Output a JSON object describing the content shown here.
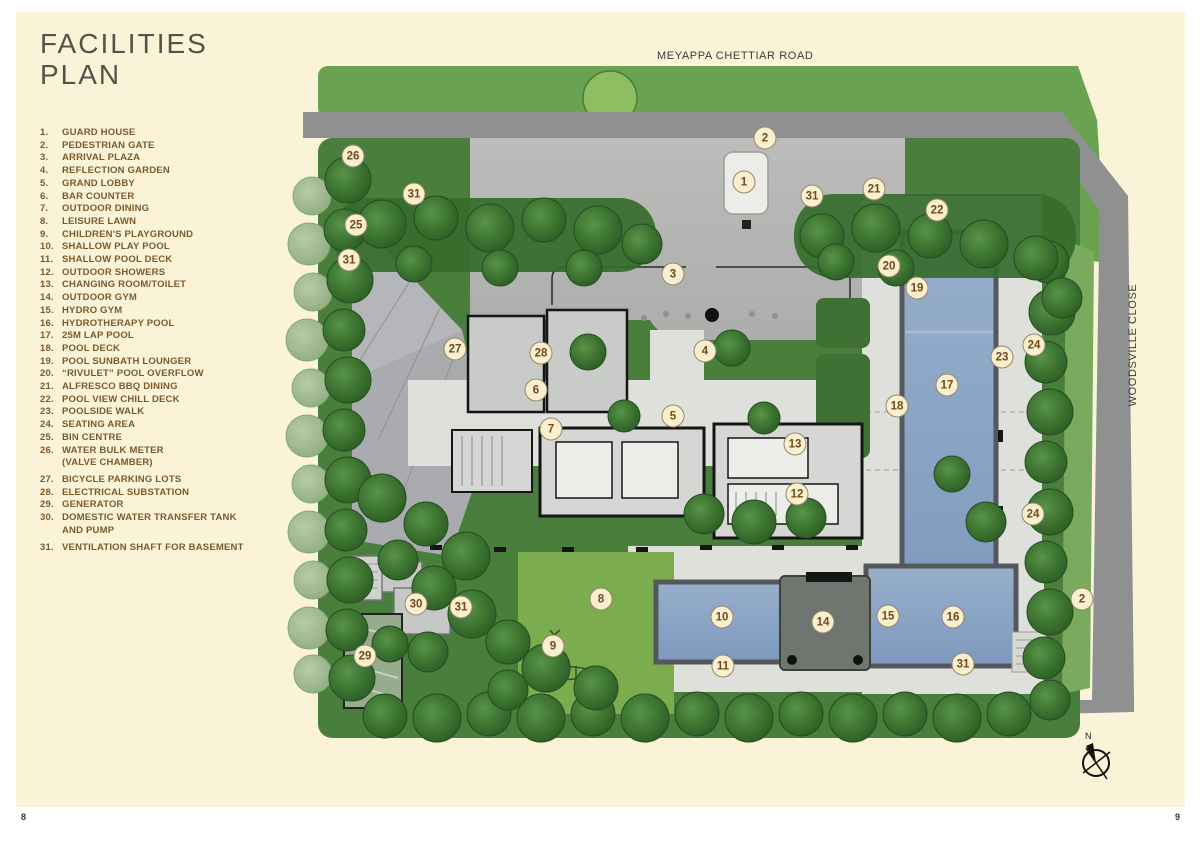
{
  "page": {
    "title_line1": "FACILITIES",
    "title_line2": "PLAN",
    "page_number_left": "8",
    "page_number_right": "9"
  },
  "roads": {
    "top_label": "MEYAPPA CHETTIAR ROAD",
    "right_label": "WOODSVILLE CLOSE"
  },
  "compass": {
    "label": "N"
  },
  "legend_items": [
    {
      "num": "1.",
      "label": "GUARD HOUSE"
    },
    {
      "num": "2.",
      "label": "PEDESTRIAN GATE"
    },
    {
      "num": "3.",
      "label": "ARRIVAL PLAZA"
    },
    {
      "num": "4.",
      "label": "REFLECTION GARDEN"
    },
    {
      "num": "5.",
      "label": "GRAND LOBBY"
    },
    {
      "num": "6.",
      "label": "BAR COUNTER"
    },
    {
      "num": "7.",
      "label": "OUTDOOR DINING"
    },
    {
      "num": "8.",
      "label": "LEISURE LAWN"
    },
    {
      "num": "9.",
      "label": "CHILDREN'S PLAYGROUND"
    },
    {
      "num": "10.",
      "label": "SHALLOW PLAY POOL"
    },
    {
      "num": "11.",
      "label": "SHALLOW POOL DECK"
    },
    {
      "num": "12.",
      "label": "OUTDOOR SHOWERS"
    },
    {
      "num": "13.",
      "label": "CHANGING ROOM/TOILET"
    },
    {
      "num": "14.",
      "label": "OUTDOOR GYM"
    },
    {
      "num": "15.",
      "label": "HYDRO GYM"
    },
    {
      "num": "16.",
      "label": "HYDROTHERAPY POOL"
    },
    {
      "num": "17.",
      "label": "25M LAP POOL"
    },
    {
      "num": "18.",
      "label": "POOL DECK"
    },
    {
      "num": "19.",
      "label": "POOL SUNBATH LOUNGER"
    },
    {
      "num": "20.",
      "label": "“RIVULET” POOL OVERFLOW"
    },
    {
      "num": "21.",
      "label": "ALFRESCO BBQ DINING"
    },
    {
      "num": "22.",
      "label": "POOL VIEW CHILL DECK"
    },
    {
      "num": "23.",
      "label": "POOLSIDE WALK"
    },
    {
      "num": "24.",
      "label": "SEATING AREA"
    },
    {
      "num": "25.",
      "label": "BIN CENTRE"
    },
    {
      "num": "26.",
      "label": "WATER BULK METER",
      "label2": "(VALVE CHAMBER)"
    },
    {
      "num": "27.",
      "label": "BICYCLE PARKING LOTS",
      "gap_before": true
    },
    {
      "num": "28.",
      "label": "ELECTRICAL SUBSTATION"
    },
    {
      "num": "29.",
      "label": "GENERATOR"
    },
    {
      "num": "30.",
      "label": "DOMESTIC WATER TRANSFER TANK",
      "label2": "AND PUMP"
    },
    {
      "num": "31.",
      "label": "VENTILATION SHAFT FOR BASEMENT",
      "gap_before": true
    }
  ],
  "markers": [
    {
      "n": "26",
      "x": 353,
      "y": 156
    },
    {
      "n": "31",
      "x": 414,
      "y": 194
    },
    {
      "n": "25",
      "x": 356,
      "y": 225
    },
    {
      "n": "31",
      "x": 349,
      "y": 260
    },
    {
      "n": "2",
      "x": 765,
      "y": 138
    },
    {
      "n": "1",
      "x": 744,
      "y": 182
    },
    {
      "n": "31",
      "x": 812,
      "y": 196
    },
    {
      "n": "21",
      "x": 874,
      "y": 189
    },
    {
      "n": "22",
      "x": 937,
      "y": 210
    },
    {
      "n": "20",
      "x": 889,
      "y": 266
    },
    {
      "n": "19",
      "x": 917,
      "y": 288
    },
    {
      "n": "3",
      "x": 673,
      "y": 274
    },
    {
      "n": "27",
      "x": 455,
      "y": 349
    },
    {
      "n": "28",
      "x": 541,
      "y": 353
    },
    {
      "n": "4",
      "x": 705,
      "y": 351
    },
    {
      "n": "6",
      "x": 536,
      "y": 390
    },
    {
      "n": "24",
      "x": 1034,
      "y": 345
    },
    {
      "n": "23",
      "x": 1002,
      "y": 357
    },
    {
      "n": "17",
      "x": 947,
      "y": 385
    },
    {
      "n": "18",
      "x": 897,
      "y": 406
    },
    {
      "n": "5",
      "x": 673,
      "y": 416
    },
    {
      "n": "7",
      "x": 551,
      "y": 429
    },
    {
      "n": "13",
      "x": 795,
      "y": 444
    },
    {
      "n": "12",
      "x": 797,
      "y": 494
    },
    {
      "n": "24",
      "x": 1033,
      "y": 514
    },
    {
      "n": "8",
      "x": 601,
      "y": 599
    },
    {
      "n": "30",
      "x": 416,
      "y": 604
    },
    {
      "n": "31",
      "x": 461,
      "y": 607
    },
    {
      "n": "9",
      "x": 553,
      "y": 646
    },
    {
      "n": "29",
      "x": 365,
      "y": 656
    },
    {
      "n": "10",
      "x": 722,
      "y": 617
    },
    {
      "n": "11",
      "x": 723,
      "y": 666
    },
    {
      "n": "14",
      "x": 823,
      "y": 622
    },
    {
      "n": "15",
      "x": 888,
      "y": 616
    },
    {
      "n": "16",
      "x": 953,
      "y": 617
    },
    {
      "n": "31",
      "x": 963,
      "y": 664
    },
    {
      "n": "2",
      "x": 1082,
      "y": 599
    }
  ],
  "colors": {
    "page_bg": "#FBF3D8",
    "title_text": "#57514A",
    "legend_text": "#7A5A2D",
    "road_text": "#3A3A3A",
    "marker_bg": "#F9EECD",
    "marker_border": "#95886B",
    "marker_text": "#6F4B1D",
    "pool_blue": "#8CA6C7",
    "tree_green": "#3A7030",
    "lawn_green": "#7BAD4F",
    "road_grey": "#8F9190",
    "page_number_text": "#333333"
  }
}
